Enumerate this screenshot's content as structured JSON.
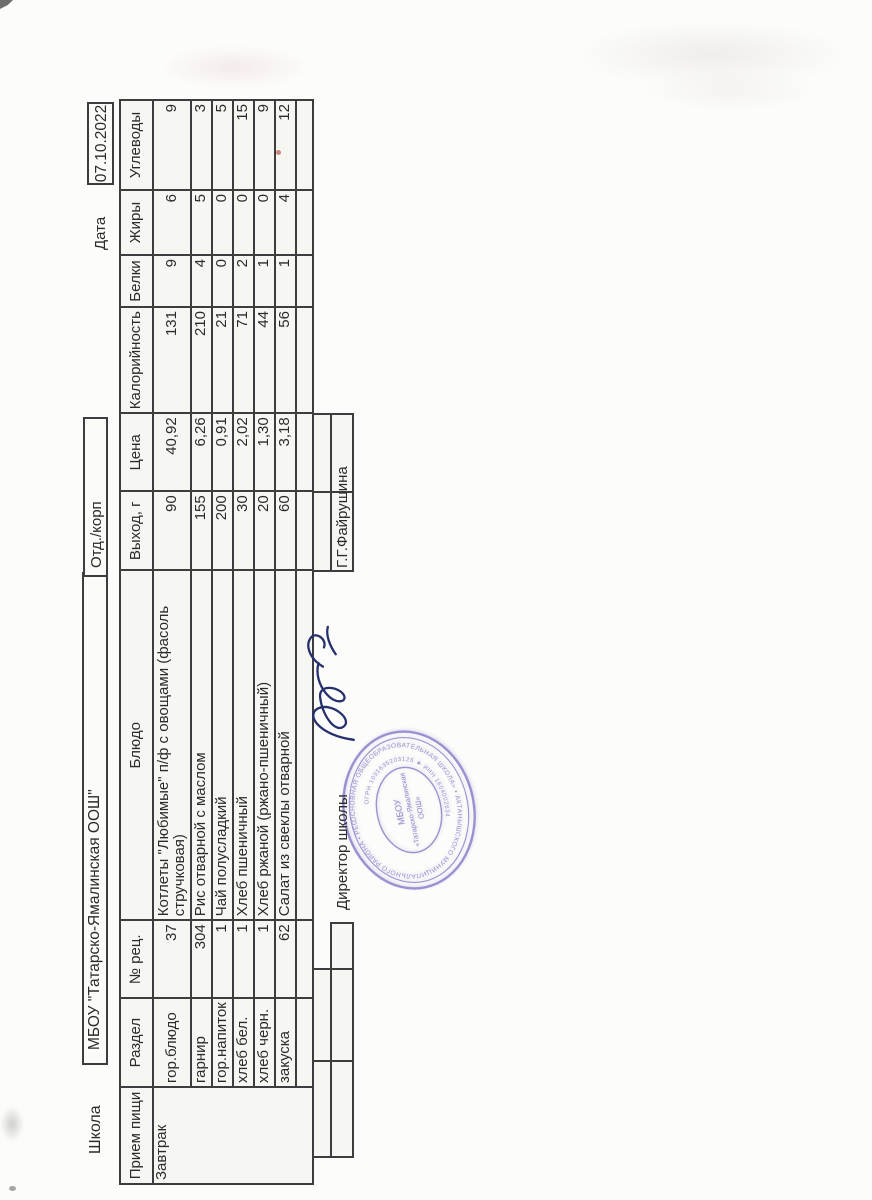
{
  "header": {
    "school_label": "Школа",
    "school_name": "МБОУ \"Татарско-Ямалинская ООШ\"",
    "dept_label": "Отд./корп",
    "date_label": "Дата",
    "date_value": "07.10.2022"
  },
  "menu_table": {
    "columns": [
      "Прием пищи",
      "Раздел",
      "№ рец.",
      "Блюдо",
      "Выход, г",
      "Цена",
      "Калорийность",
      "Белки",
      "Жиры",
      "Углеводы"
    ],
    "meal": "Завтрак",
    "rows": [
      {
        "section": "гор.блюдо",
        "recipe": "37",
        "dish": "Котлеты \"Любимые\" п/ф с овощами (фасоль стручковая)",
        "output": "90",
        "price": "40,92",
        "calories": "131",
        "protein": "9",
        "fat": "6",
        "carbs": "9"
      },
      {
        "section": "гарнир",
        "recipe": "304",
        "dish": "Рис отварной с маслом",
        "output": "155",
        "price": "6,26",
        "calories": "210",
        "protein": "4",
        "fat": "5",
        "carbs": "3"
      },
      {
        "section": "гор.напиток",
        "recipe": "1",
        "dish": "Чай полусладкий",
        "output": "200",
        "price": "0,91",
        "calories": "21",
        "protein": "0",
        "fat": "0",
        "carbs": "5"
      },
      {
        "section": "хлеб бел.",
        "recipe": "1",
        "dish": "Хлеб пшеничный",
        "output": "30",
        "price": "2,02",
        "calories": "71",
        "protein": "2",
        "fat": "0",
        "carbs": "15"
      },
      {
        "section": "хлеб черн.",
        "recipe": "1",
        "dish": "Хлеб ржаной (ржано-пшеничный)",
        "output": "20",
        "price": "1,30",
        "calories": "44",
        "protein": "1",
        "fat": "0",
        "carbs": "9"
      },
      {
        "section": "закуска",
        "recipe": "62",
        "dish": "Салат из свеклы отварной",
        "output": "60",
        "price": "3,18",
        "calories": "56",
        "protein": "1",
        "fat": "4",
        "carbs": "12"
      }
    ]
  },
  "footer": {
    "director_label": "Директор школы",
    "director_name": "Г.Г.Файрушина"
  },
  "stamp": {
    "ring_text_outer": "ОСНОВНАЯ ОБЩЕОБРАЗОВАТЕЛЬНАЯ ШКОЛА» • АКТАНЫШСКОГО МУНИЦИПАЛЬНОГО РАЙОНА • РЕСПУБЛИКИ ТАТАРСТАН",
    "ring_text_inner": "ОГРН 1031635203126 ★ ИНН 1604002634",
    "center_line1": "МБОУ",
    "center_line2": "«Татарско-Ямалинская",
    "center_line3": "ООШ»",
    "color": "#8d7ec9"
  }
}
